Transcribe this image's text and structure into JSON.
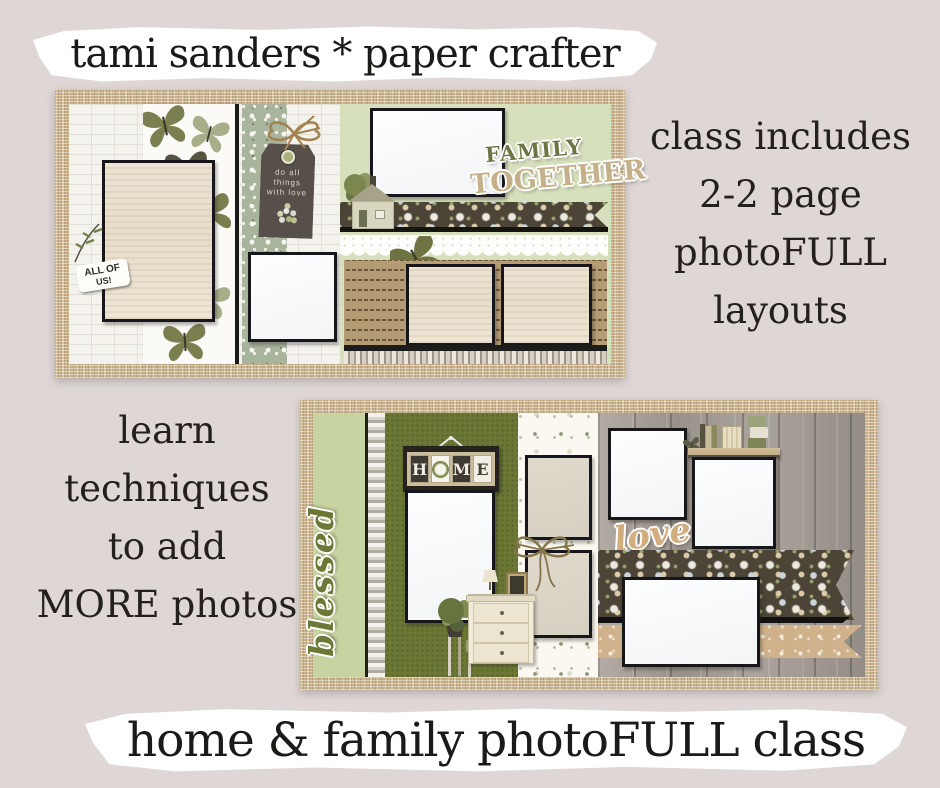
{
  "header": {
    "title": "tami sanders * paper crafter"
  },
  "footer": {
    "title": "home & family photoFULL class"
  },
  "class_includes": {
    "lines": [
      "class includes",
      "2-2 page",
      "photoFULL",
      "layouts"
    ]
  },
  "learn": {
    "lines": [
      "learn",
      "techniques",
      "to add",
      "MORE photos"
    ]
  },
  "layout_top": {
    "all_of_us_line1": "ALL OF",
    "all_of_us_line2": "US!",
    "tag_line1": "do all",
    "tag_line2": "things",
    "tag_line3": "with love",
    "title_family": "FAMILY",
    "title_together": "TOGETHER"
  },
  "layout_bottom": {
    "blessed": "blessed",
    "home": "HOME",
    "love": "love"
  },
  "colors": {
    "background": "#ded7d5",
    "banner_white": "#ffffff",
    "text_black": "#1c1a18",
    "burlap_tan": "#c7b08a",
    "sage_page_green": "#d6e0bd",
    "light_green": "#c7d3a0",
    "olive_panel": "#6b7734",
    "olive_lettering": "#6d7544",
    "dark_floral_brown": "#4b4437",
    "kraft_brown": "#b49c74",
    "sticker_tan": "#cfb28c",
    "wood_gray": "#a6a099"
  }
}
